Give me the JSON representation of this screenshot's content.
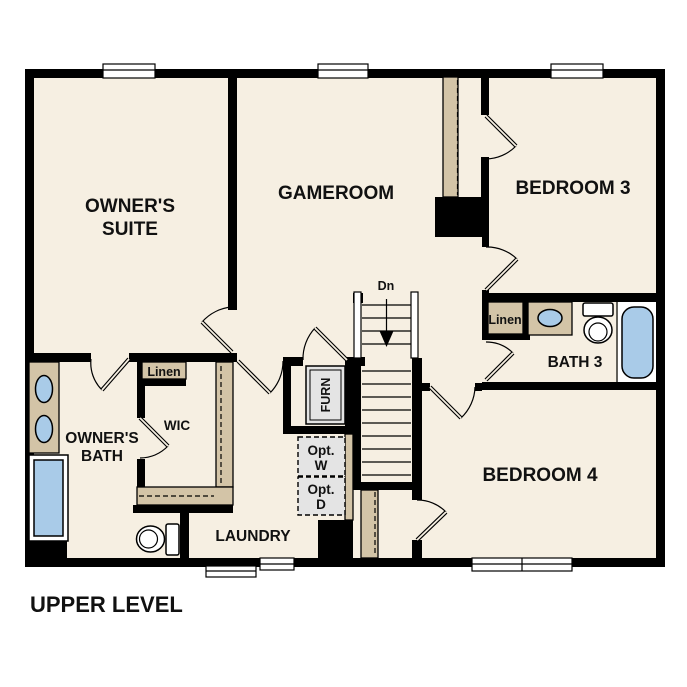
{
  "title": "UPPER LEVEL",
  "rooms": {
    "owners_suite": {
      "line1": "OWNER'S",
      "line2": "SUITE"
    },
    "gameroom": {
      "label": "GAMEROOM"
    },
    "bedroom3": {
      "label": "BEDROOM 3"
    },
    "bedroom4": {
      "label": "BEDROOM 4"
    },
    "bath3": {
      "label": "BATH 3"
    },
    "owners_bath": {
      "line1": "OWNER'S",
      "line2": "BATH"
    },
    "wic": {
      "label": "WIC"
    },
    "laundry": {
      "label": "LAUNDRY"
    }
  },
  "labels": {
    "linen_hall": "Linen",
    "linen_wic": "Linen",
    "furnace": "FURN",
    "stairs_down": "Dn",
    "opt_washer": {
      "line1": "Opt.",
      "line2": "W"
    },
    "opt_dryer": {
      "line1": "Opt.",
      "line2": "D"
    }
  },
  "colors": {
    "floor": "#f6efe2",
    "wall": "#000000",
    "cabinet_tan": "#d3c4a7",
    "fixture_blue": "#a9cbe8",
    "appliance_gray": "#e4e4e4",
    "background": "#ffffff"
  }
}
